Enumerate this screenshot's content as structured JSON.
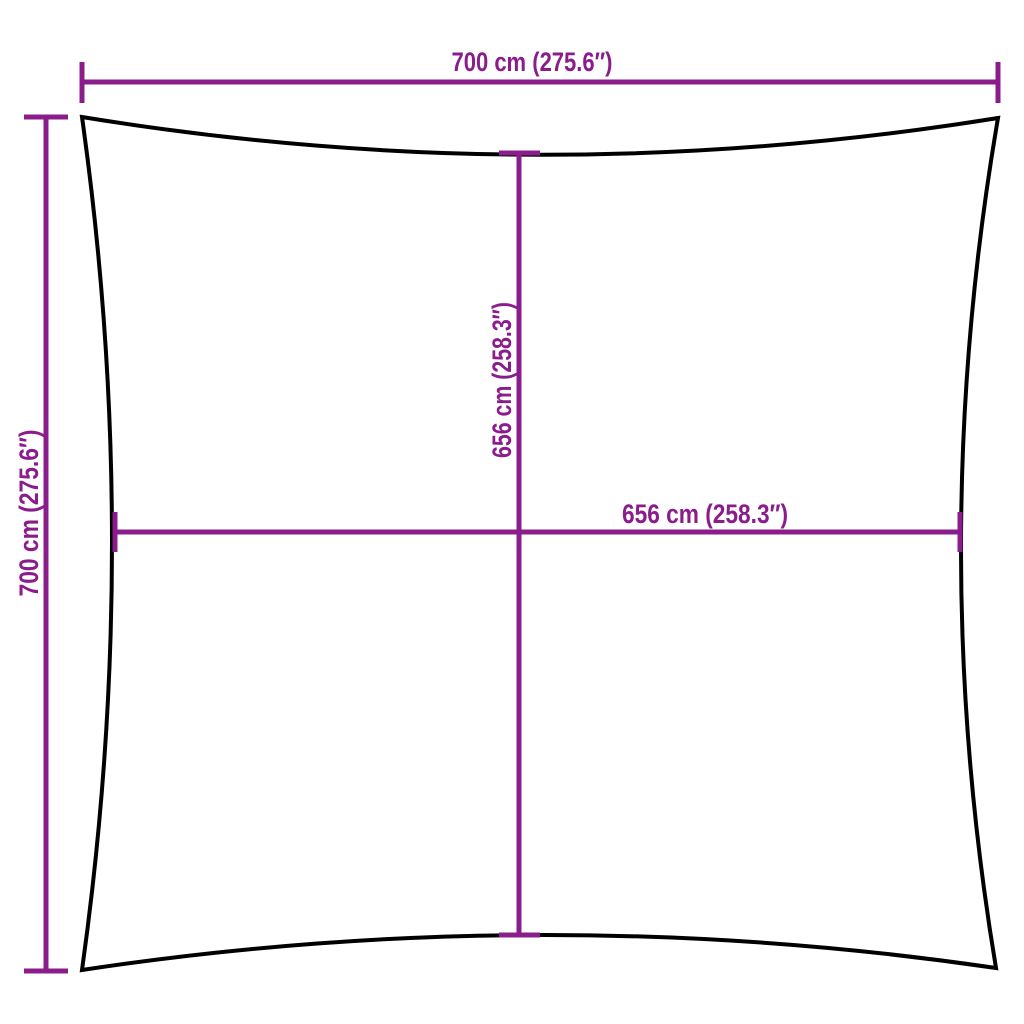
{
  "colors": {
    "accent": "#8A1C8C",
    "outline": "#000000",
    "background": "#FFFFFF"
  },
  "diagram": {
    "type": "product-dimension-diagram",
    "subject": "square shade sail with concave edges",
    "dimensions": {
      "top_width": {
        "label": "700 cm (275.6″)",
        "value_cm": 700,
        "value_in": 275.6
      },
      "left_height": {
        "label": "700 cm (275.6″)",
        "value_cm": 700,
        "value_in": 275.6
      },
      "inner_height": {
        "label": "656 cm (258.3″)",
        "value_cm": 656,
        "value_in": 258.3
      },
      "inner_width": {
        "label": "656 cm (258.3″)",
        "value_cm": 656,
        "value_in": 258.3
      }
    }
  }
}
